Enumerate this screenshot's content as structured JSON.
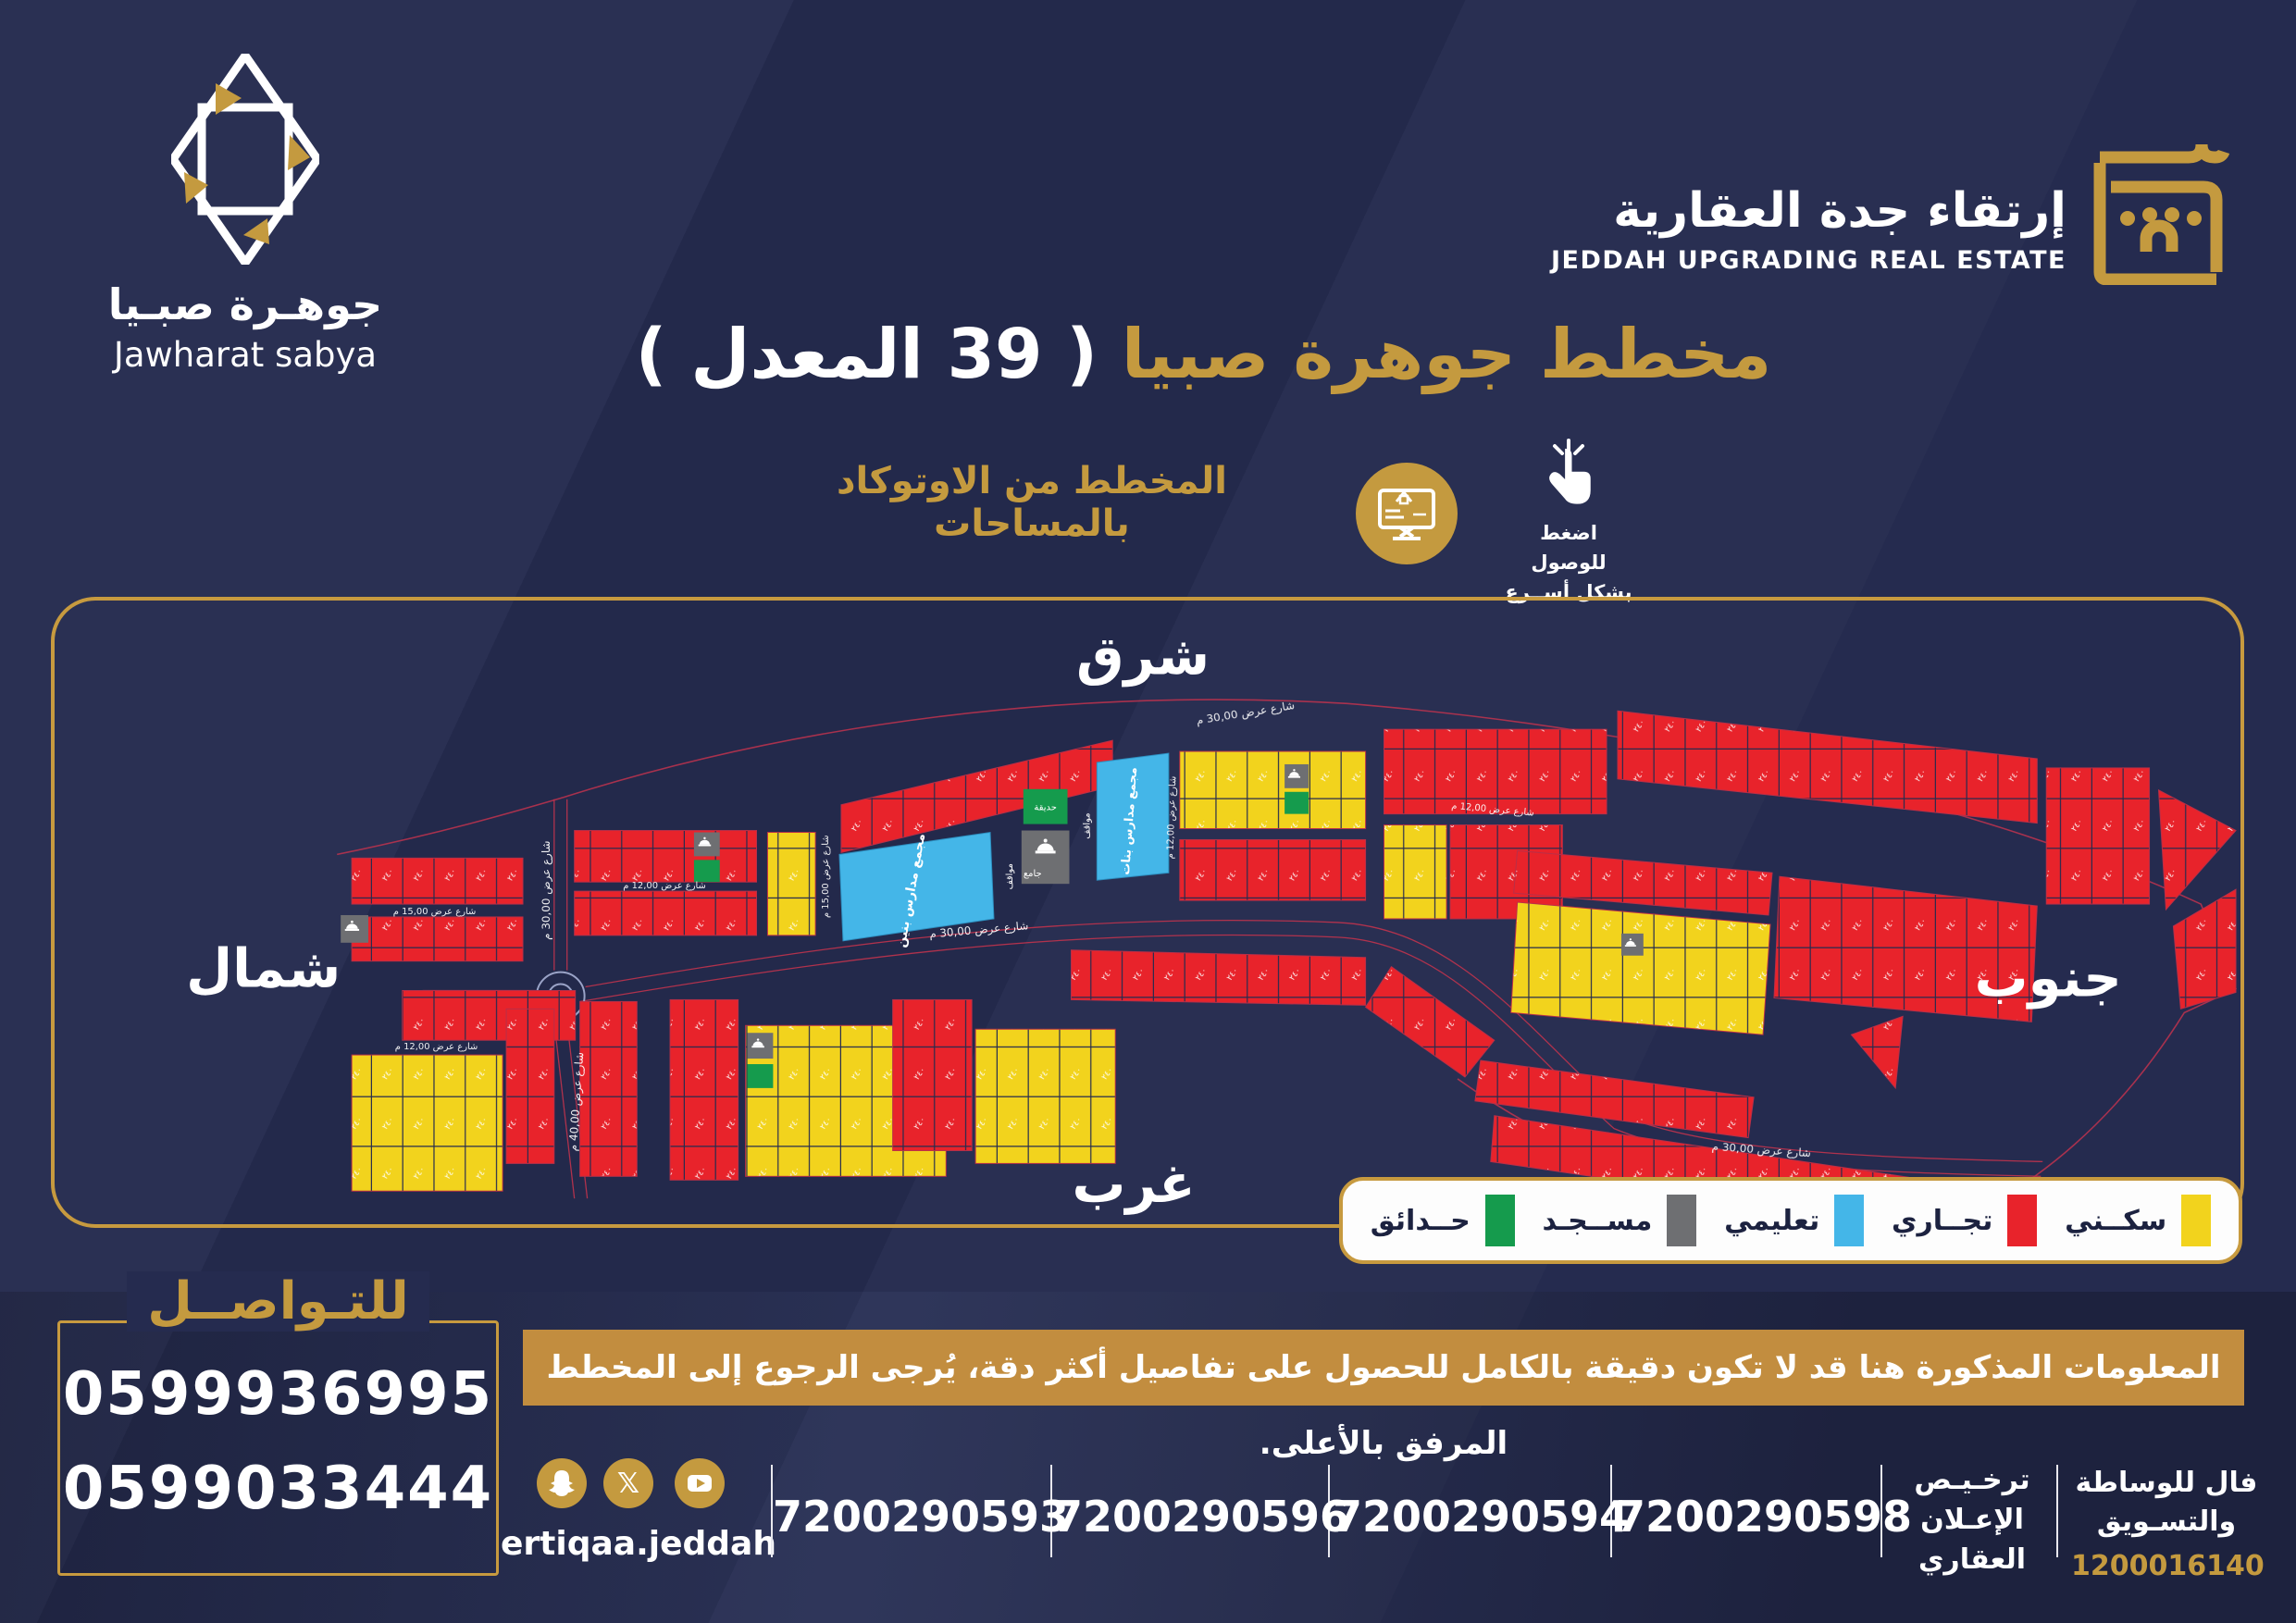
{
  "brand": {
    "name_ar": "جوهـرة صبـيا",
    "name_en": "Jawharat sabya"
  },
  "agency": {
    "name_ar": "إرتقاء جدة العقارية",
    "name_en": "JEDDAH UPGRADING REAL ESTATE"
  },
  "title": {
    "main": "مخطط جوهرة صبيا",
    "suffix": "( 39 المعدل )"
  },
  "subtitle": "المخطط من الاوتوكاد بالمساحات",
  "access_note": {
    "line1": "اضغط للوصول",
    "line2": "بشكل أســرع"
  },
  "map": {
    "directions": {
      "east": "شرق",
      "north": "شمال",
      "south": "جنوب",
      "west": "غرب"
    },
    "streets": {
      "w40": "شارع عرض 40,00 م",
      "w30": "شارع عرض 30,00 م",
      "w15": "شارع عرض 15,00 م",
      "w12": "شارع عرض 12,00 م"
    },
    "areas": {
      "boys_school": "مجمع مدارس بنين",
      "girls_school": "مجمع مدارس بنات",
      "mosque": "جامع",
      "park": "حديقة",
      "parking": "مواقف"
    },
    "plot_number_sample": "٢٤٠",
    "colors": {
      "residential": "#f2d31d",
      "commercial": "#e8232b",
      "educational": "#44b6e8",
      "mosque": "#6e6f72",
      "parks": "#159b4d",
      "street_line": "#c0334d",
      "border_gold": "#c79a3f"
    }
  },
  "legend": {
    "items": [
      {
        "label": "سكــني",
        "color": "#f2d31d"
      },
      {
        "label": "تجــاري",
        "color": "#e8232b"
      },
      {
        "label": "تعليمي",
        "color": "#44b6e8"
      },
      {
        "label": "مســجـد",
        "color": "#6e6f72"
      },
      {
        "label": "حــدائق",
        "color": "#159b4d"
      }
    ]
  },
  "disclaimer": "المعلومات المذكورة هنا قد لا تكون دقيقة بالكامل  للحصول على تفاصيل أكثر دقة، يُرجى الرجوع إلى المخطط المرفق بالأعلى.",
  "contact": {
    "title": "للتـواصــل",
    "phones": [
      "0599936995",
      "0599033444"
    ]
  },
  "social": {
    "handle": "ertiqaa.jeddah",
    "icons": [
      "snapchat",
      "x",
      "youtube"
    ],
    "x_glyph": "𝕏"
  },
  "licenses": {
    "numbers": [
      "7200290593",
      "7200290596",
      "7200290594",
      "7200290598"
    ],
    "ad_license": {
      "line1": "ترخـيـص",
      "line2": "الإعـلان",
      "line3": "العقاري"
    },
    "fal": {
      "line1": "فال للوساطة",
      "line2": "والتسـويق",
      "number": "1200016140"
    }
  }
}
